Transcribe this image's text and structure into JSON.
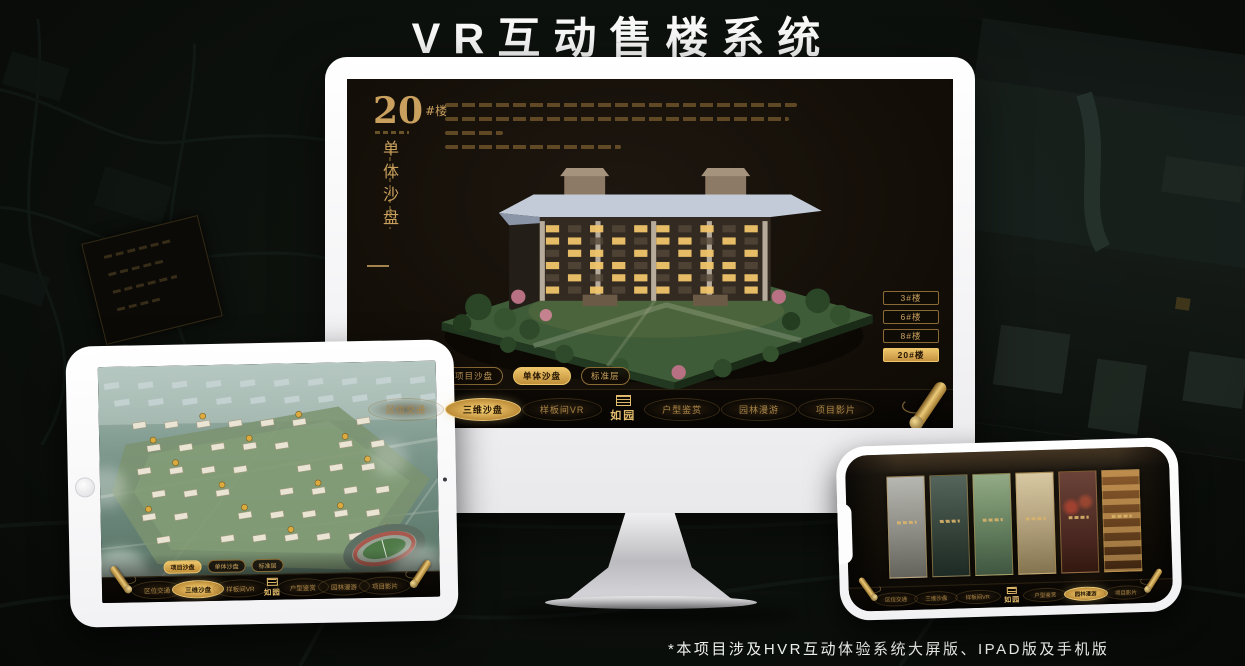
{
  "header": {
    "title": "VR互动售楼系统"
  },
  "footnote": "*本项目涉及HVR互动体验系统大屏版、IPAD版及手机版",
  "brand": {
    "name": "如园"
  },
  "colors": {
    "gold": "#c9a05e",
    "gold_bright": "#e9c878",
    "screen_bg": "#17120b",
    "background": "#0c100c"
  },
  "monitor": {
    "headline": {
      "number": "20",
      "unit": "#楼",
      "subtitle_vertical": "单体沙盘"
    },
    "floor_buttons": [
      {
        "label": "3#楼",
        "active": false
      },
      {
        "label": "6#楼",
        "active": false
      },
      {
        "label": "8#楼",
        "active": false
      },
      {
        "label": "20#楼",
        "active": true
      }
    ],
    "subtabs": [
      {
        "label": "项目沙盘",
        "active": false
      },
      {
        "label": "单体沙盘",
        "active": true
      },
      {
        "label": "标准层",
        "active": false
      }
    ],
    "nav": {
      "items": [
        {
          "label": "区位交通",
          "active": false
        },
        {
          "label": "三维沙盘",
          "active": true
        },
        {
          "label": "样板间VR",
          "active": false
        },
        {
          "label": "户型鉴赏",
          "active": false
        },
        {
          "label": "园林漫游",
          "active": false
        },
        {
          "label": "项目影片",
          "active": false
        }
      ],
      "logo": "如园"
    }
  },
  "tablet": {
    "subtabs": [
      {
        "label": "项目沙盘",
        "active": true
      },
      {
        "label": "单体沙盘",
        "active": false
      },
      {
        "label": "标准层",
        "active": false
      }
    ],
    "nav": {
      "items": [
        {
          "label": "区位交通",
          "active": false
        },
        {
          "label": "三维沙盘",
          "active": true
        },
        {
          "label": "样板间VR",
          "active": false
        },
        {
          "label": "户型鉴赏",
          "active": false
        },
        {
          "label": "园林漫游",
          "active": false
        },
        {
          "label": "项目影片",
          "active": false
        }
      ],
      "logo": "如园"
    }
  },
  "phone": {
    "nav": {
      "items": [
        {
          "label": "区位交通",
          "active": false
        },
        {
          "label": "三维沙盘",
          "active": false
        },
        {
          "label": "样板间VR",
          "active": false
        },
        {
          "label": "户型鉴赏",
          "active": false
        },
        {
          "label": "园林漫游",
          "active": true
        },
        {
          "label": "项目影片",
          "active": false
        }
      ],
      "logo": "如园"
    }
  }
}
